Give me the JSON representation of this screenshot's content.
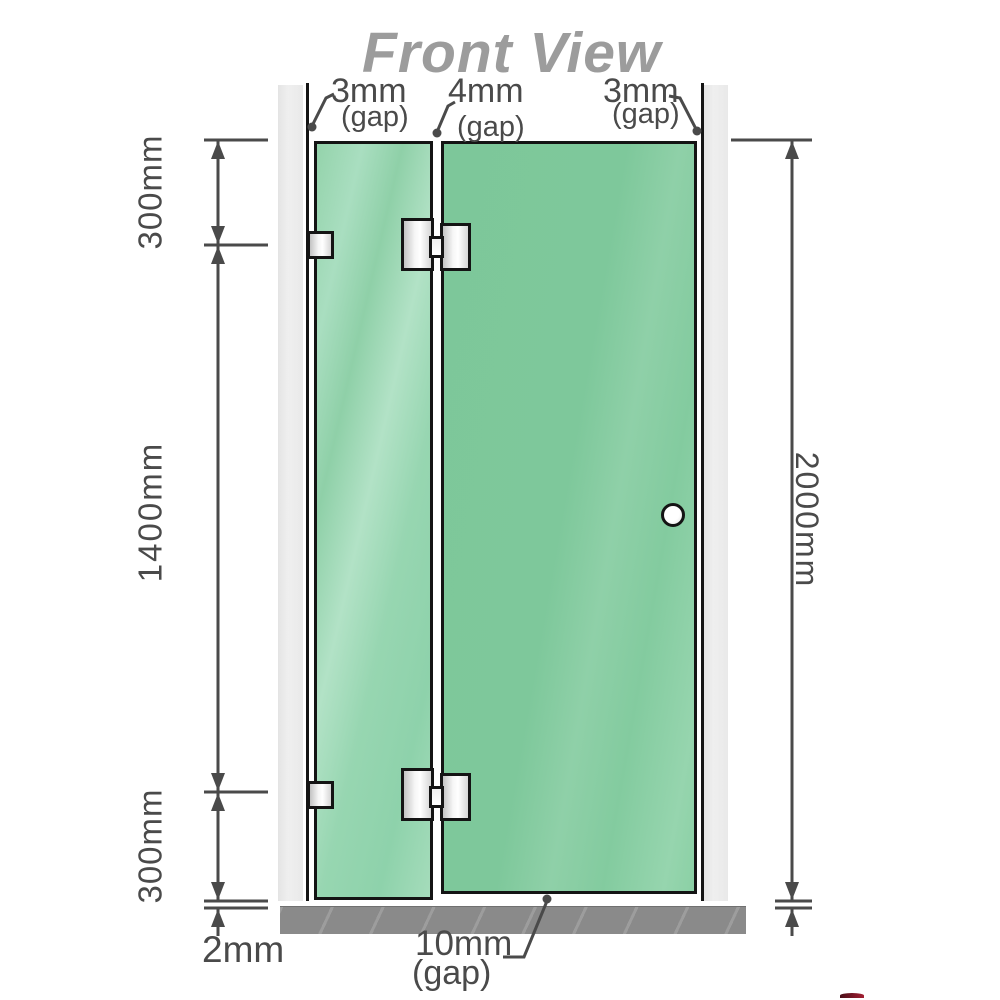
{
  "title": "Front View",
  "labels": {
    "gap_top_left": "3mm",
    "gap_top_left_note": "(gap)",
    "gap_top_mid": "4mm",
    "gap_top_mid_note": "(gap)",
    "gap_top_right": "3mm",
    "gap_top_right_note": "(gap)",
    "dim_left_top": "300mm",
    "dim_left_mid": "1400mm",
    "dim_left_bottom": "300mm",
    "dim_bottom_left": "2mm",
    "dim_right_total": "2000mm",
    "gap_bottom": "10mm",
    "gap_bottom_note": "(gap)"
  },
  "colors": {
    "glass_green": "#7ec89b",
    "glass_highlight": "#b2e2c6",
    "wall_gray": "#e9e9e9",
    "floor_gray": "#8a8a8a",
    "outline_black": "#141414",
    "dimension_gray": "#4a4a4a",
    "title_gray": "#9c9c9c",
    "knob_white": "#ffffff",
    "watermark_red": "#a41f33"
  }
}
